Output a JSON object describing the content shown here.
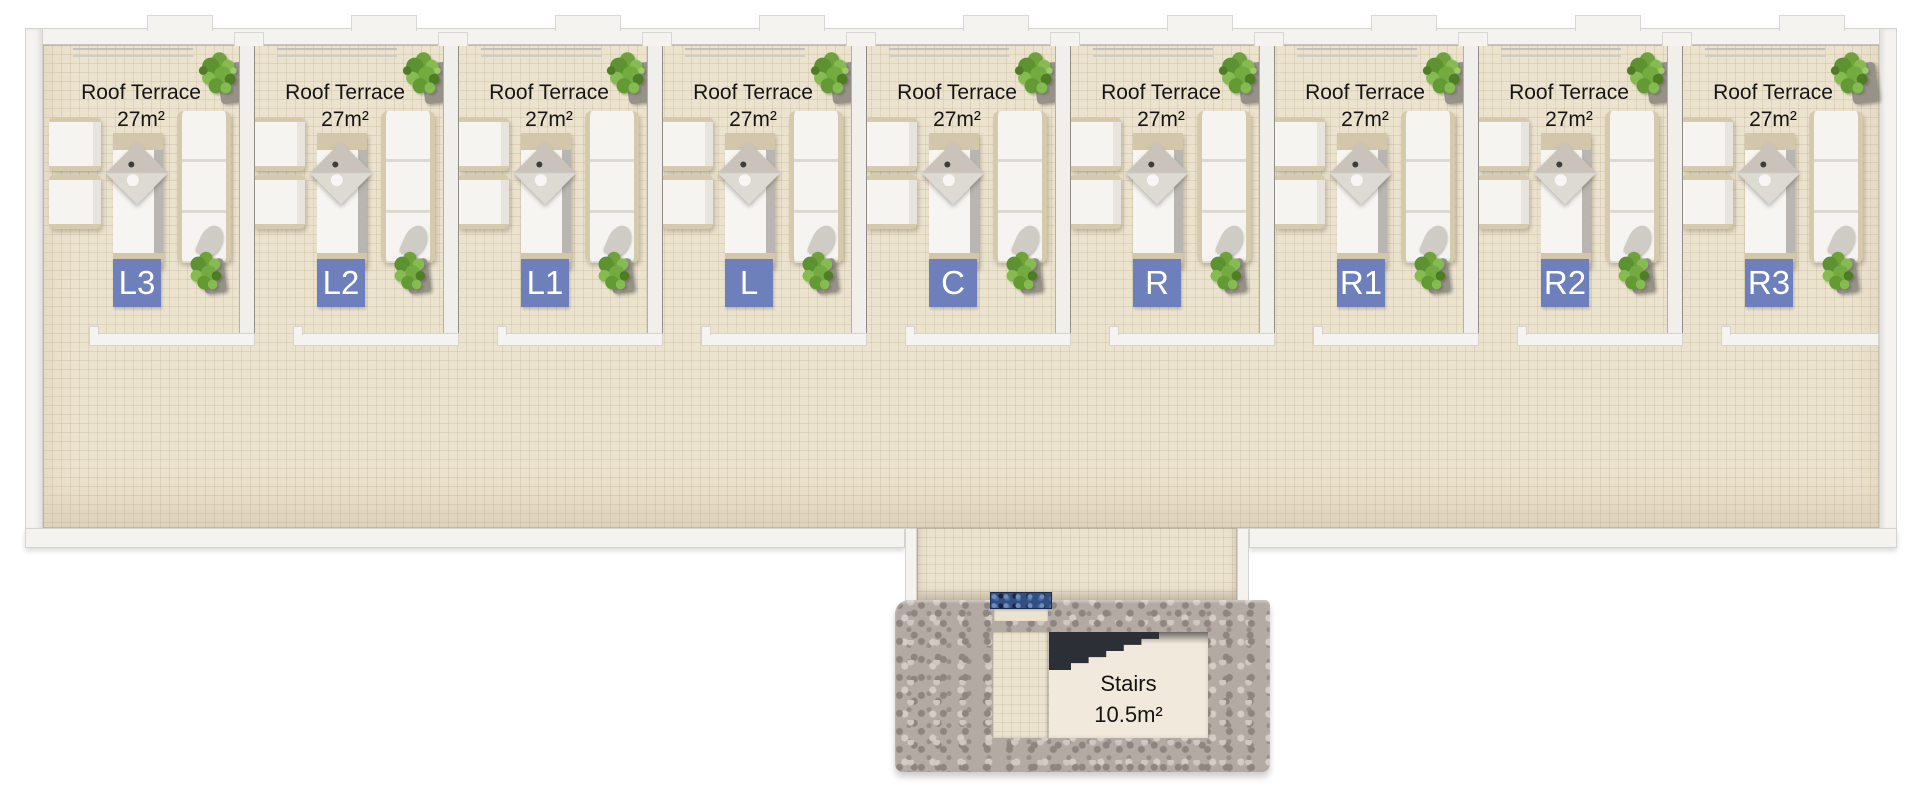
{
  "plan": {
    "units": [
      {
        "code": "L3",
        "name": "Roof Terrace",
        "area": "27m²"
      },
      {
        "code": "L2",
        "name": "Roof Terrace",
        "area": "27m²"
      },
      {
        "code": "L1",
        "name": "Roof Terrace",
        "area": "27m²"
      },
      {
        "code": "L",
        "name": "Roof Terrace",
        "area": "27m²"
      },
      {
        "code": "C",
        "name": "Roof Terrace",
        "area": "27m²"
      },
      {
        "code": "R",
        "name": "Roof Terrace",
        "area": "27m²"
      },
      {
        "code": "R1",
        "name": "Roof Terrace",
        "area": "27m²"
      },
      {
        "code": "R2",
        "name": "Roof Terrace",
        "area": "27m²"
      },
      {
        "code": "R3",
        "name": "Roof Terrace",
        "area": "27m²"
      }
    ],
    "stairs": {
      "name": "Stairs",
      "area": "10.5m²"
    },
    "colors": {
      "wall_white": "#f4f3f0",
      "floor_beige": "#ece3cf",
      "badge_blue": "#6d80bb",
      "stone_grey": "#b3aaa4",
      "plant_green": "#74a83f",
      "mosaic_blue": "#31507f"
    }
  }
}
